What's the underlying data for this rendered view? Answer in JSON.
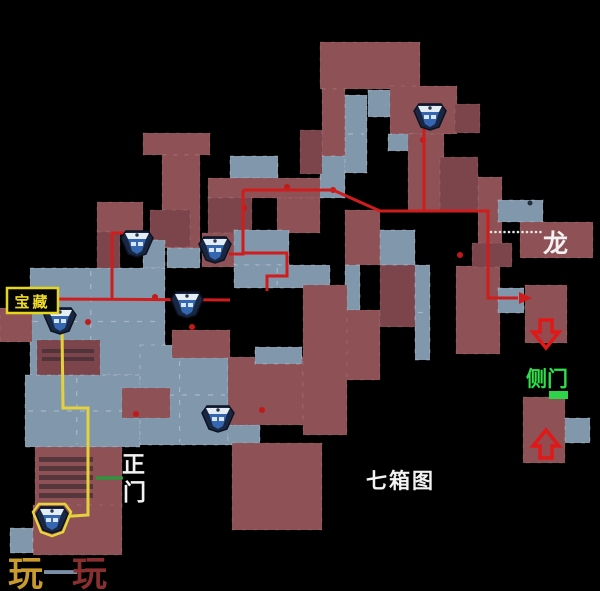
{
  "labels": {
    "treasure": {
      "text": "宝藏",
      "color": "#ecd92a",
      "box_border": "#e6d619",
      "box_bg": "#050505"
    },
    "dragon": {
      "text": "龙",
      "color": "#f2f2f2"
    },
    "side_door": {
      "text": "侧门",
      "color": "#2ee04a"
    },
    "main_gate": {
      "chars": [
        "正",
        "门"
      ],
      "color": "#f2f2f2"
    },
    "map_name": {
      "text": "七箱图",
      "color": "#f2f2f2"
    },
    "watermark": {
      "chars": [
        {
          "t": "玩",
          "color": "#c99b2e"
        },
        {
          "t": "一",
          "color": "#7a8fa6"
        },
        {
          "t": "玩",
          "color": "#8a2f2f"
        }
      ]
    }
  },
  "map": {
    "background": "#000000",
    "room_colors": {
      "r": "#8d5156",
      "r2": "#7c444b",
      "b": "#8197ac"
    },
    "rooms": [
      [
        320,
        42,
        100,
        47,
        "r"
      ],
      [
        322,
        89,
        23,
        67,
        "r"
      ],
      [
        320,
        156,
        25,
        42,
        "b"
      ],
      [
        345,
        95,
        22,
        78,
        "b"
      ],
      [
        368,
        90,
        24,
        27,
        "b"
      ],
      [
        390,
        86,
        67,
        48,
        "r"
      ],
      [
        455,
        104,
        25,
        29,
        "r2"
      ],
      [
        388,
        134,
        25,
        17,
        "b"
      ],
      [
        408,
        134,
        36,
        76,
        "r"
      ],
      [
        300,
        130,
        22,
        44,
        "r2"
      ],
      [
        143,
        133,
        67,
        22,
        "r"
      ],
      [
        162,
        155,
        38,
        93,
        "r"
      ],
      [
        150,
        210,
        40,
        37,
        "r2"
      ],
      [
        167,
        248,
        33,
        20,
        "b"
      ],
      [
        143,
        240,
        22,
        28,
        "b"
      ],
      [
        230,
        156,
        48,
        22,
        "b"
      ],
      [
        208,
        178,
        112,
        20,
        "r"
      ],
      [
        208,
        198,
        44,
        35,
        "r2"
      ],
      [
        277,
        198,
        43,
        35,
        "r"
      ],
      [
        202,
        233,
        32,
        34,
        "r"
      ],
      [
        234,
        230,
        55,
        35,
        "b"
      ],
      [
        234,
        265,
        96,
        23,
        "b"
      ],
      [
        345,
        210,
        35,
        55,
        "r"
      ],
      [
        345,
        265,
        15,
        45,
        "b"
      ],
      [
        345,
        310,
        35,
        70,
        "r"
      ],
      [
        380,
        265,
        35,
        62,
        "r2"
      ],
      [
        415,
        265,
        15,
        95,
        "b"
      ],
      [
        380,
        230,
        35,
        35,
        "b"
      ],
      [
        456,
        266,
        44,
        88,
        "r"
      ],
      [
        498,
        288,
        26,
        25,
        "b"
      ],
      [
        472,
        243,
        40,
        24,
        "r2"
      ],
      [
        478,
        177,
        24,
        66,
        "r"
      ],
      [
        498,
        200,
        45,
        22,
        "b"
      ],
      [
        520,
        222,
        73,
        36,
        "r"
      ],
      [
        440,
        157,
        38,
        53,
        "r2"
      ],
      [
        525,
        285,
        42,
        58,
        "r"
      ],
      [
        523,
        397,
        42,
        66,
        "r"
      ],
      [
        565,
        418,
        25,
        25,
        "b"
      ],
      [
        30,
        268,
        135,
        107,
        "b"
      ],
      [
        97,
        202,
        46,
        30,
        "r"
      ],
      [
        97,
        232,
        23,
        36,
        "r2"
      ],
      [
        37,
        340,
        63,
        35,
        "r2"
      ],
      [
        0,
        308,
        32,
        34,
        "r"
      ],
      [
        25,
        375,
        115,
        72,
        "b"
      ],
      [
        140,
        345,
        88,
        100,
        "b"
      ],
      [
        172,
        330,
        58,
        28,
        "r"
      ],
      [
        228,
        425,
        32,
        20,
        "b"
      ],
      [
        122,
        388,
        48,
        30,
        "r"
      ],
      [
        35,
        447,
        87,
        63,
        "r"
      ],
      [
        33,
        505,
        89,
        50,
        "r"
      ],
      [
        10,
        528,
        23,
        25,
        "b"
      ],
      [
        228,
        357,
        75,
        68,
        "r"
      ],
      [
        232,
        443,
        90,
        87,
        "r"
      ],
      [
        303,
        285,
        44,
        150,
        "r"
      ],
      [
        255,
        347,
        47,
        17,
        "b"
      ]
    ],
    "stairs_color": "#4a3136",
    "stairs": [
      [
        39,
        457,
        54,
        5
      ],
      [
        39,
        466,
        54,
        5
      ],
      [
        39,
        475,
        54,
        5
      ],
      [
        39,
        484,
        54,
        5
      ],
      [
        39,
        493,
        54,
        5
      ],
      [
        42,
        349,
        52,
        4
      ],
      [
        42,
        357,
        52,
        4
      ]
    ],
    "routes": {
      "red_color": "#cf1d1d",
      "red": [
        [
          [
            243,
            190
          ],
          [
            333,
            190
          ],
          [
            380,
            211
          ],
          [
            488,
            211
          ],
          [
            488,
            298
          ],
          [
            518,
            298
          ]
        ],
        [
          [
            424,
            211
          ],
          [
            424,
            128
          ]
        ],
        [
          [
            243,
            190
          ],
          [
            243,
            254
          ],
          [
            229,
            254
          ]
        ],
        [
          [
            243,
            253
          ],
          [
            287,
            253
          ],
          [
            287,
            276
          ],
          [
            267,
            276
          ],
          [
            267,
            291
          ]
        ],
        [
          [
            50,
            299
          ],
          [
            230,
            300
          ]
        ],
        [
          [
            126,
            233
          ],
          [
            112,
            233
          ],
          [
            112,
            299
          ]
        ]
      ],
      "red_arrowhead": [
        [
          519,
          292
        ],
        [
          519,
          304
        ],
        [
          532,
          298
        ]
      ],
      "yellow_color": "#e3d23b",
      "yellow": [
        [
          [
            62,
            327
          ],
          [
            63,
            408
          ],
          [
            88,
            408
          ],
          [
            88,
            515
          ],
          [
            58,
            517
          ]
        ]
      ],
      "green_line_color": "#1f9e3a",
      "green_line": [
        [
          96,
          478
        ],
        [
          123,
          478
        ]
      ]
    },
    "dots_color": "#c01a1a",
    "dots": [
      [
        287,
        187
      ],
      [
        333,
        190
      ],
      [
        244,
        208
      ],
      [
        423,
        140
      ],
      [
        460,
        255
      ],
      [
        155,
        297
      ],
      [
        88,
        322
      ],
      [
        192,
        327
      ],
      [
        262,
        410
      ],
      [
        136,
        414
      ]
    ],
    "dark_dots": [
      [
        530,
        203
      ]
    ],
    "dotted_line": {
      "y": 232,
      "x1": 491,
      "x2": 541,
      "step": 4.5,
      "color": "#e9e9e9"
    },
    "green_door": {
      "x": 549,
      "y": 391,
      "w": 19,
      "h": 8,
      "color": "#2ed34a"
    },
    "arrows": {
      "color": "#e01818",
      "items": [
        {
          "cx": 546,
          "cy": 334,
          "dir": "down"
        },
        {
          "cx": 546,
          "cy": 444,
          "dir": "up"
        }
      ]
    },
    "icons": [
      {
        "x": 430,
        "y": 116,
        "ring": false
      },
      {
        "x": 137,
        "y": 243,
        "ring": false
      },
      {
        "x": 215,
        "y": 249,
        "ring": false
      },
      {
        "x": 60,
        "y": 320,
        "ring": false
      },
      {
        "x": 187,
        "y": 304,
        "ring": false
      },
      {
        "x": 218,
        "y": 418,
        "ring": false
      },
      {
        "x": 52,
        "y": 519,
        "ring": true
      }
    ],
    "icon_colors": {
      "outer": "#1a2742",
      "edge": "#0a1322",
      "top": "#e4ecf4",
      "body": "#3566b2",
      "mark": "#d8e6f2",
      "ring": "#e8d438"
    }
  }
}
